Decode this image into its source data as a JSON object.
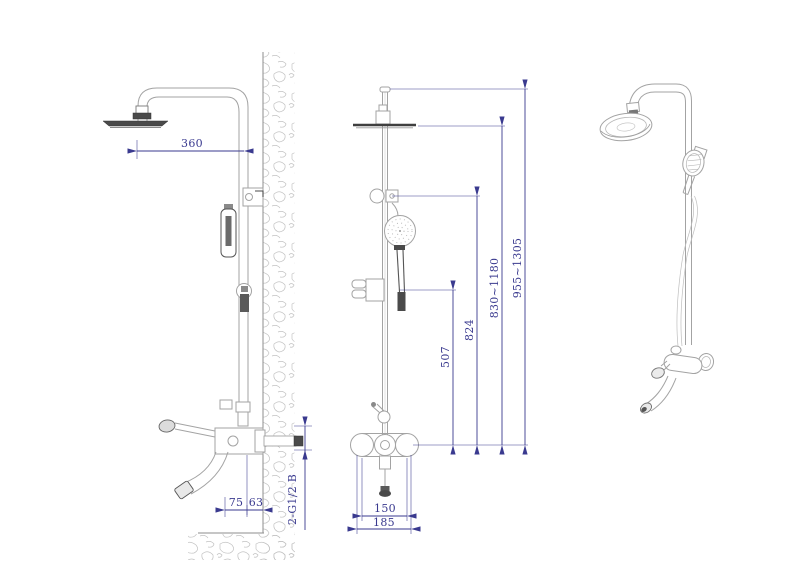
{
  "drawing": {
    "type": "technical-drawing",
    "subject": "exposed thermostatic shower column set, three orthographic/perspective views",
    "colors": {
      "background": "#ffffff",
      "dimension": "#3a3a8f",
      "line_light": "#a3a3a3",
      "line_dark": "#4a4a4a",
      "hatch": "#c2c2c2"
    },
    "views": {
      "side": "side-elevation-with-wall-section",
      "front": "front-elevation",
      "perspective": "perspective-view"
    },
    "dimensions": {
      "arm_reach": "360",
      "spout_reach": "75",
      "spout_to_wall_offset": "63",
      "inlet_connection": "2-G1/2 B",
      "holder_to_valve": "507",
      "outlet_to_valve": "824",
      "head_height_range": "830~1180",
      "overall_height_range": "955~1305",
      "valve_centres": "150",
      "valve_overall_width": "185"
    }
  }
}
